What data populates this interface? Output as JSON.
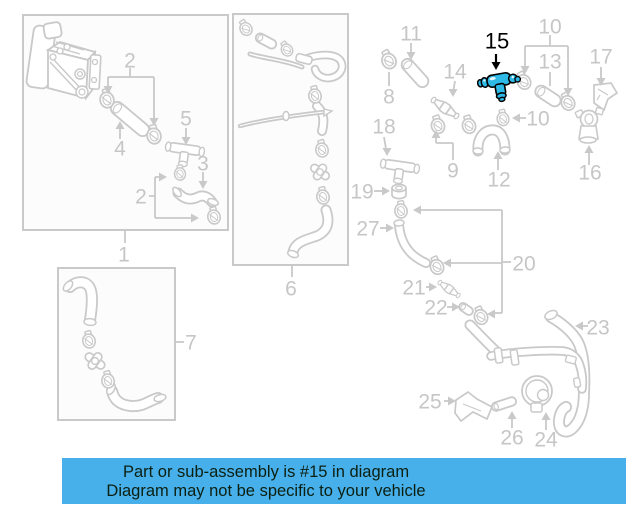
{
  "page": {
    "background": "#ffffff"
  },
  "colors": {
    "banner_background": "#47afe9",
    "banner_text": "#0c2012",
    "diagram_gray": "#c9c9c9",
    "label_gray": "#c6c6c6",
    "box_fill": "#fcfcfc",
    "highlight_fill": "#2fb9e6",
    "highlight_stroke": "#000000"
  },
  "banner": {
    "line1": "Part or sub-assembly is #15 in diagram",
    "line2": "Diagram may not be specific to your vehicle"
  },
  "diagram": {
    "highlighted_part": "15",
    "labels": [
      {
        "id": "2",
        "text": "2",
        "x": 130,
        "y": 60
      },
      {
        "id": "4",
        "text": "4",
        "x": 120,
        "y": 148
      },
      {
        "id": "5",
        "text": "5",
        "x": 186,
        "y": 118
      },
      {
        "id": "3",
        "text": "3",
        "x": 203,
        "y": 163
      },
      {
        "id": "2b",
        "text": "2",
        "x": 141,
        "y": 196
      },
      {
        "id": "1",
        "text": "1",
        "x": 124,
        "y": 254
      },
      {
        "id": "6",
        "text": "6",
        "x": 291,
        "y": 288
      },
      {
        "id": "7",
        "text": "7",
        "x": 191,
        "y": 342
      },
      {
        "id": "11",
        "text": "11",
        "x": 411,
        "y": 33
      },
      {
        "id": "8",
        "text": "8",
        "x": 389,
        "y": 96
      },
      {
        "id": "14",
        "text": "14",
        "x": 455,
        "y": 71
      },
      {
        "id": "15",
        "text": "15",
        "x": 497,
        "y": 41,
        "highlighted": true
      },
      {
        "id": "10",
        "text": "10",
        "x": 550,
        "y": 26
      },
      {
        "id": "13",
        "text": "13",
        "x": 550,
        "y": 61
      },
      {
        "id": "17",
        "text": "17",
        "x": 601,
        "y": 56
      },
      {
        "id": "18",
        "text": "18",
        "x": 384,
        "y": 126
      },
      {
        "id": "9",
        "text": "9",
        "x": 453,
        "y": 170
      },
      {
        "id": "10b",
        "text": "10",
        "x": 538,
        "y": 118
      },
      {
        "id": "12",
        "text": "12",
        "x": 499,
        "y": 179
      },
      {
        "id": "16",
        "text": "16",
        "x": 590,
        "y": 172
      },
      {
        "id": "19",
        "text": "19",
        "x": 362,
        "y": 191
      },
      {
        "id": "27",
        "text": "27",
        "x": 368,
        "y": 228
      },
      {
        "id": "20",
        "text": "20",
        "x": 524,
        "y": 263
      },
      {
        "id": "21",
        "text": "21",
        "x": 414,
        "y": 287
      },
      {
        "id": "22",
        "text": "22",
        "x": 436,
        "y": 307
      },
      {
        "id": "23",
        "text": "23",
        "x": 598,
        "y": 327
      },
      {
        "id": "25",
        "text": "25",
        "x": 430,
        "y": 401
      },
      {
        "id": "26",
        "text": "26",
        "x": 512,
        "y": 437
      },
      {
        "id": "24",
        "text": "24",
        "x": 546,
        "y": 439
      }
    ]
  }
}
